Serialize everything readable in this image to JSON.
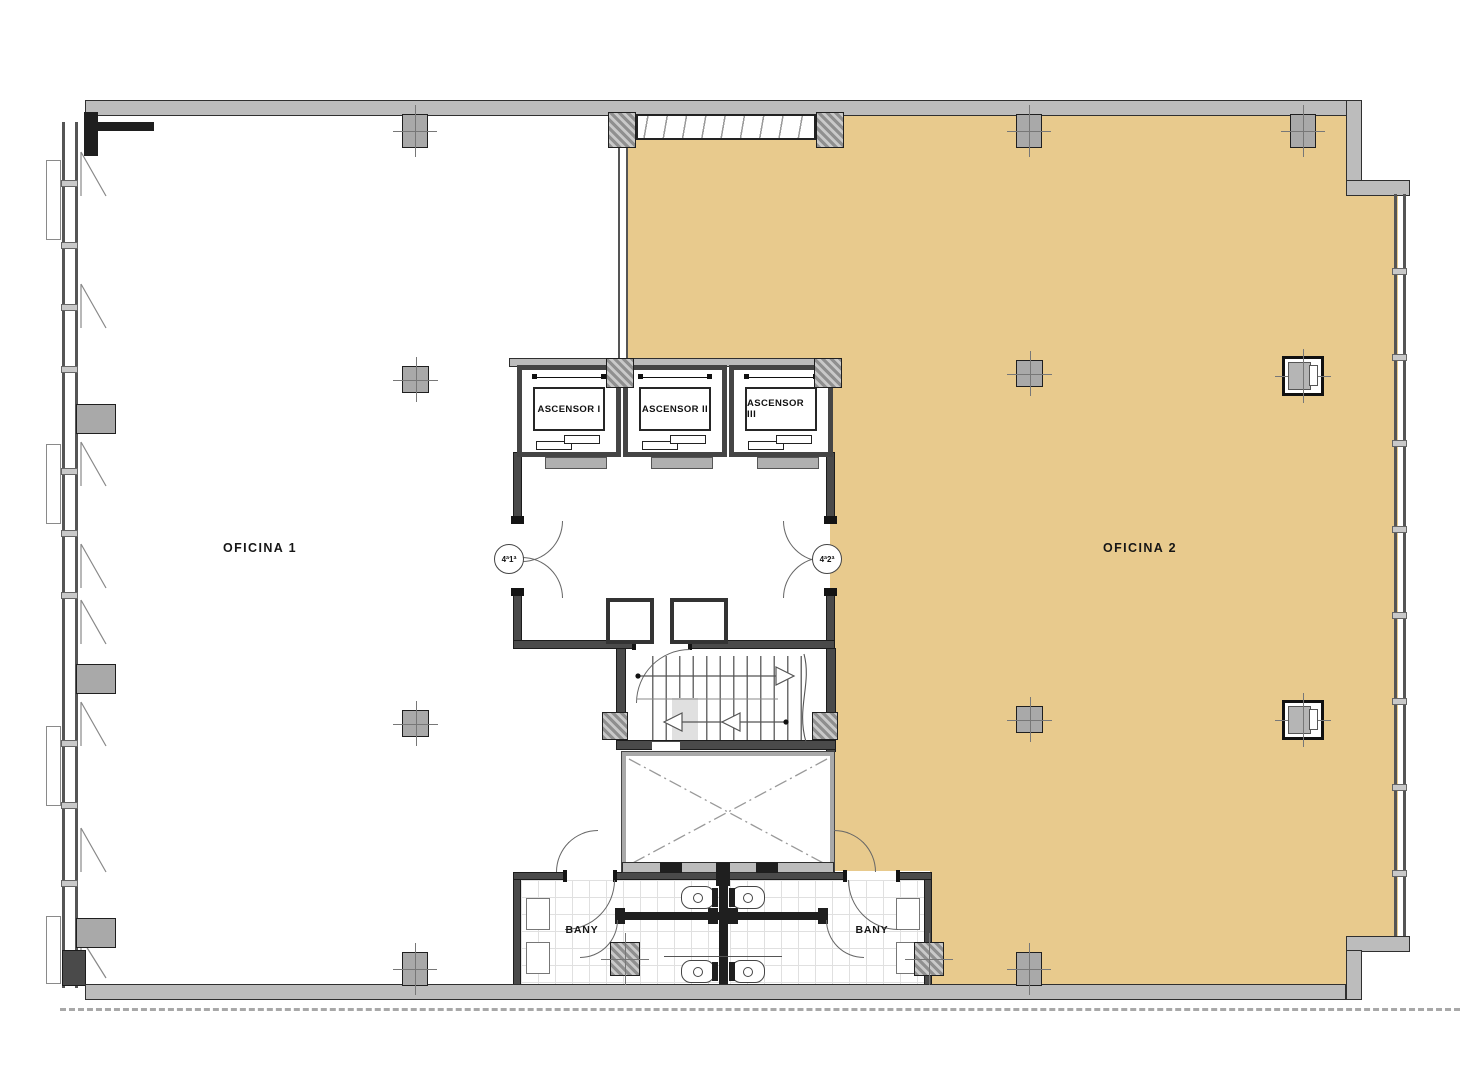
{
  "plan": {
    "rooms": {
      "oficina1": "OFICINA 1",
      "oficina2": "OFICINA 2",
      "bany_left": "BANY",
      "bany_right": "BANY"
    },
    "elevators": [
      "ASCENSOR I",
      "ASCENSOR II",
      "ASCENSOR III"
    ],
    "door_tags": {
      "left": "4ª1ª",
      "right": "4ª2ª"
    },
    "colors": {
      "highlight": "#e8ca8d",
      "wall_gray": "#bcbcbc",
      "wall_dark": "#454545",
      "line": "#555555"
    }
  }
}
